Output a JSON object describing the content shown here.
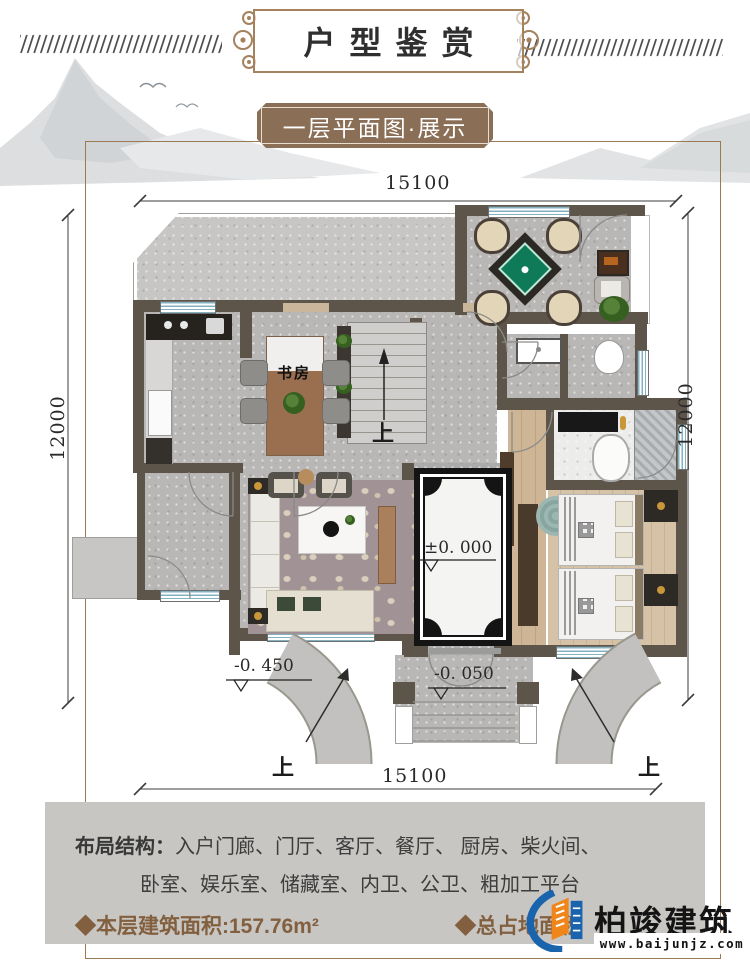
{
  "header": {
    "title": "户型鉴赏"
  },
  "banner": {
    "label": "一层平面图·展示"
  },
  "plan": {
    "dimensions": {
      "top": "15100",
      "bottom": "15100",
      "left": "12000",
      "right": "12000"
    },
    "labels": {
      "study": "书房",
      "level_entry": "±0. 000",
      "level_porch": "-0. 050",
      "level_ramp": "-0. 450",
      "up": "上"
    }
  },
  "info": {
    "layout_label": "布局结构：",
    "layout_line1": "入户门廊、门厅、客厅、餐厅、 厨房、柴火间、",
    "layout_line2": "卧室、娱乐室、储藏室、内卫、公卫、粗加工平台",
    "floor_area": "◆本层建筑面积:157.76m²",
    "total_area": "◆总占地面积"
  },
  "logo": {
    "name": "柏竣建筑",
    "website": "www.baijunjz.com"
  },
  "colors": {
    "banner_brown": "#8a6e55",
    "frame_brown": "#9a7a54",
    "wall": "#5d544a",
    "logo_blue": "#1a63ad",
    "logo_orange": "#f08519",
    "area_text_brown": "#82603f"
  }
}
